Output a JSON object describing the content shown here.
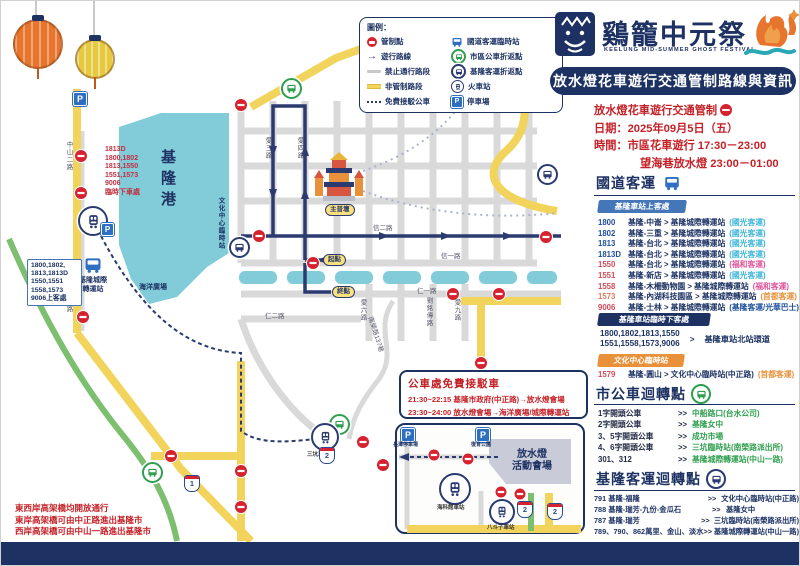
{
  "header": {
    "title": "鷄籠中元祭",
    "subtitle": "KEELUNG MID-SUMMER GHOST FESTIVAL",
    "banner": "放水燈花車遊行交通管制路線與資訊"
  },
  "notice": {
    "control": "放水燈花車遊行交通管制",
    "date": "日期：2025年09月5日（五）",
    "time": "時間：市區花車遊行 17:30－23:00",
    "time2": "望海巷放水燈 23:00－01:00"
  },
  "highway": {
    "title": "國道客運",
    "board_badge": "基隆車站上客處",
    "routes": [
      {
        "no": "1800",
        "desc": "基隆-中崙 >  基隆城際轉運站",
        "op": "(國光客運)"
      },
      {
        "no": "1802",
        "desc": "基隆-三重 >  基隆城際轉運站",
        "op": "(國光客運)"
      },
      {
        "no": "1813",
        "desc": "基隆-台北 >  基隆城際轉運站",
        "op": "(國光客運)"
      },
      {
        "no": "1813D",
        "desc": "基隆-台北 >  基隆城際轉運站",
        "op": "(國光客運)"
      },
      {
        "no": "1550",
        "desc": "基隆-台北 >  基隆城際轉運站",
        "op": "(福和客運)"
      },
      {
        "no": "1551",
        "desc": "基隆-新店 >  基隆城際轉運站",
        "op": "(國光客運)"
      },
      {
        "no": "1558",
        "desc": "基隆-木柵動物園 >  基隆城際轉運站",
        "op": "(福和客運)"
      },
      {
        "no": "1573",
        "desc": "基隆-內湖科技園區 >  基隆城際轉運站",
        "op": "(首都客運)"
      },
      {
        "no": "9006",
        "desc": "基隆-士林 >  基隆城際轉運站",
        "op": "(基隆客運/光華巴士)"
      }
    ],
    "drop_badge": "基隆車站臨時下客處",
    "drop_nums1": "1800,1802,1813,1550",
    "drop_nums2": "1551,1558,1573,9006",
    "drop_arrow": ">",
    "drop_dest": "基隆車站北站環道",
    "culture_badge": "文化中心臨時站",
    "culture": {
      "no": "1579",
      "desc": "基隆-圓山 >  文化中心臨時站(中正路)",
      "op": "(首都客運)"
    }
  },
  "city_bus": {
    "title": "市公車迴轉點",
    "arrow": ">>",
    "rows": [
      {
        "label": "1字開頭公車",
        "value": "中船路口(台水公司)"
      },
      {
        "label": "2字開頭公車",
        "value": "基隆女中"
      },
      {
        "label": "3、5字開頭公車",
        "value": "成功市場"
      },
      {
        "label": "4、6字開頭公車",
        "value": "三坑臨時站(南榮路派出所)"
      },
      {
        "label": "301、312",
        "value": "基隆城際轉運站(中山一路)"
      }
    ]
  },
  "keelung_bus": {
    "title": "基隆客運迴轉點",
    "arrow": ">>",
    "rows": [
      {
        "label": "791 基隆-福隆",
        "value": "文化中心臨時站(中正路)"
      },
      {
        "label": "788 基隆-瑞芳-九份-金瓜石",
        "value": "基隆女中"
      },
      {
        "label": "787 基隆-瑞芳",
        "value": "三坑臨時站(南榮路派出所)"
      },
      {
        "label": "789、790、862萬里、金山、淡水",
        "value": "基隆城際轉運站(中山一路)"
      }
    ]
  },
  "legend": {
    "title": "圖例：",
    "left": [
      "管制點",
      "遊行路線",
      "禁止通行路段",
      "非管制路段",
      "免費接駁公車"
    ],
    "right": [
      "國道客運臨時站",
      "市區公車折返點",
      "基隆客運折返點",
      "火車站",
      "停車場"
    ]
  },
  "map": {
    "harbor": "基隆港",
    "ocean_plaza": "海洋廣場",
    "temple": "主普壇",
    "start": "起點",
    "end": "終點",
    "terminal_line1": "基隆城際",
    "terminal_line2": "轉運站",
    "culture_stop": "文化中心臨時站",
    "venue_line1": "放水燈",
    "venue_line2": "活動會場",
    "stations": {
      "sankeng": "三坑車站",
      "museum": "海科館車站",
      "badouzi": "八斗子車站"
    },
    "parking": {
      "left": "長潭停車場",
      "right": "復育公園"
    },
    "shields": {
      "s1": "1",
      "s2": "2"
    },
    "topleft_lines": [
      "1813D",
      "1800,1802",
      "1813,1550",
      "1551,1573",
      "9006",
      "臨時下車處"
    ],
    "board_box": [
      "1800,1802,",
      "1813,1813D",
      "1550,1551",
      "1558,1573",
      "9006上客處"
    ],
    "shuttle": {
      "title": "公車處免費接駁車",
      "line1": "21:30~22:15 基隆市政府(中正路)→放水燈會場",
      "line2": "23:30~24:00 放水燈會場→海洋廣場/城際轉運站"
    },
    "west_notes": [
      "東西岸高架橋均開放通行",
      "東岸高架橋可由中正路進出基隆市",
      "西岸高架橋可由中山一路進出基隆市"
    ],
    "roads": {
      "zhongzheng": "中正路",
      "xin1": "信一路",
      "xin2": "信二路",
      "ren1": "仁一路",
      "ren2": "仁二路",
      "ai3": "愛三路",
      "ai4": "愛四路",
      "ai6": "愛六路",
      "liu": "劉銘傳路",
      "ai9": "愛九路",
      "zs1": "中山一路",
      "zs2": "中山二路",
      "nanrong": "南榮路137巷"
    }
  },
  "icons": {
    "parking": "P"
  },
  "colors": {
    "navy": "#1d3263",
    "red": "#c42127",
    "badge_blue": "#4577b8",
    "orange": "#e8913a",
    "green": "#2f9e4e",
    "pink": "#e0569b",
    "guoguang_blue": "#3fb6d8",
    "harbor_teal": "#82cbd8",
    "road_yellow": "#f2d45c",
    "control_red": "#d4232e"
  }
}
